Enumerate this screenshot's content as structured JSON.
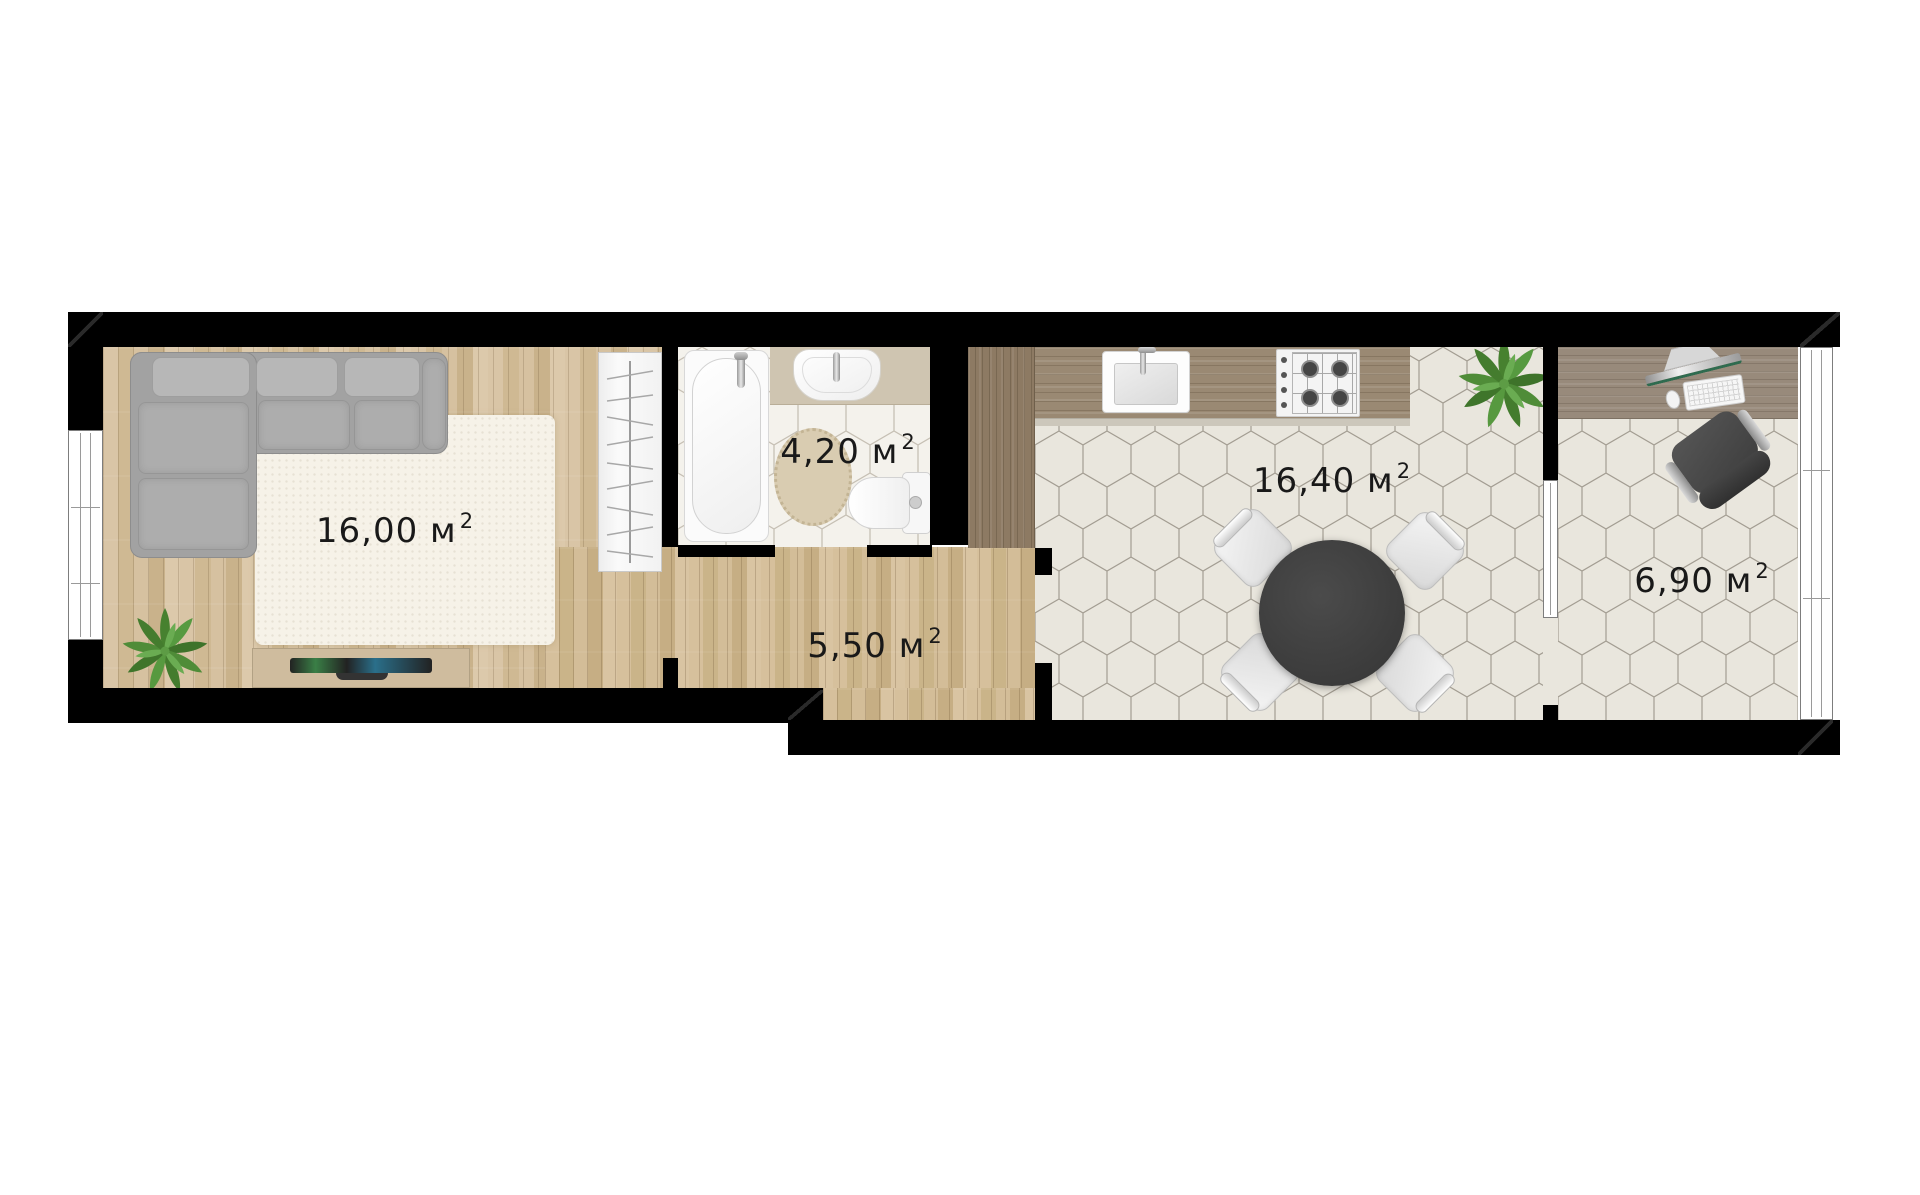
{
  "floor_plan": {
    "rooms": {
      "living": {
        "area": "16,00 м",
        "sup": "2"
      },
      "bathroom": {
        "area": "4,20 м",
        "sup": "2"
      },
      "hallway": {
        "area": "5,50 м",
        "sup": "2"
      },
      "kitchen": {
        "area": "16,40 м",
        "sup": "2"
      },
      "office": {
        "area": "6,90 м",
        "sup": "2"
      }
    },
    "colors": {
      "wall": "#000000",
      "wood_floor": "#d5c09d",
      "hall_wood_floor": "#d2bc96",
      "bath_tile": "#f4f2ec",
      "kitchen_tile": "#e9e6dd",
      "counter_wood": "#9a8973",
      "plant_green": "#47812f",
      "sofa_gray": "#a2a2a2",
      "dining_table_dark": "#3d3d3d",
      "label_text": "#191919"
    }
  }
}
